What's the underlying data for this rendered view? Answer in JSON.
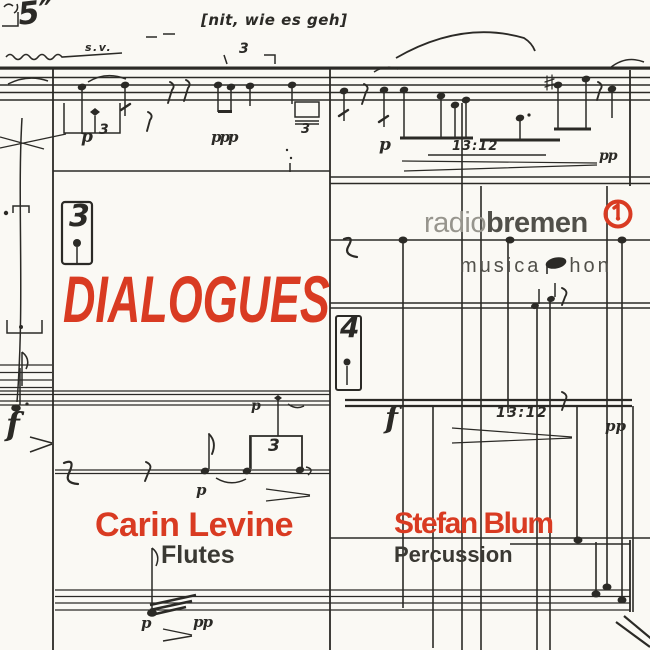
{
  "album": {
    "title": "DIALOGUES",
    "performers": [
      {
        "name": "Carin Levine",
        "instrument": "Flutes"
      },
      {
        "name": "Stefan Blum",
        "instrument": "Percussion"
      }
    ]
  },
  "logos": {
    "radio_bremen": {
      "light": "radio",
      "bold": "bremen",
      "icon": "radio-bremen-ring-icon"
    },
    "musicaphon": {
      "left": "musica",
      "right": "hon",
      "icon": "notehead-icon"
    }
  },
  "score_marks": {
    "duration_top_left": "5″",
    "sv": "s.v.",
    "inscription": "[nit, wie es geh]",
    "tuplet_top": "3",
    "p_top": "p",
    "three_top": "3",
    "ppp_top": "ppp",
    "three_small_top": "3",
    "time_top": "13:12",
    "p_top_right": "p",
    "pp_top_right": "pp",
    "meter_box_left": "3",
    "meter_box_right": "4",
    "f_left": "f",
    "p_mid_upper": "p",
    "tuplet_mid": "3",
    "p_mid_lower": "p",
    "f_right": "f",
    "time_right": "13:12",
    "pp_right": "pp",
    "p_bottom": "p",
    "pp_bottom": "pp"
  },
  "colors": {
    "background": "#faf9f4",
    "ink": "#2b2a26",
    "accent_red": "#d93b22",
    "logo_light_gray": "#97958d",
    "logo_dark_gray": "#51504a",
    "name_text": "#3a3933"
  }
}
